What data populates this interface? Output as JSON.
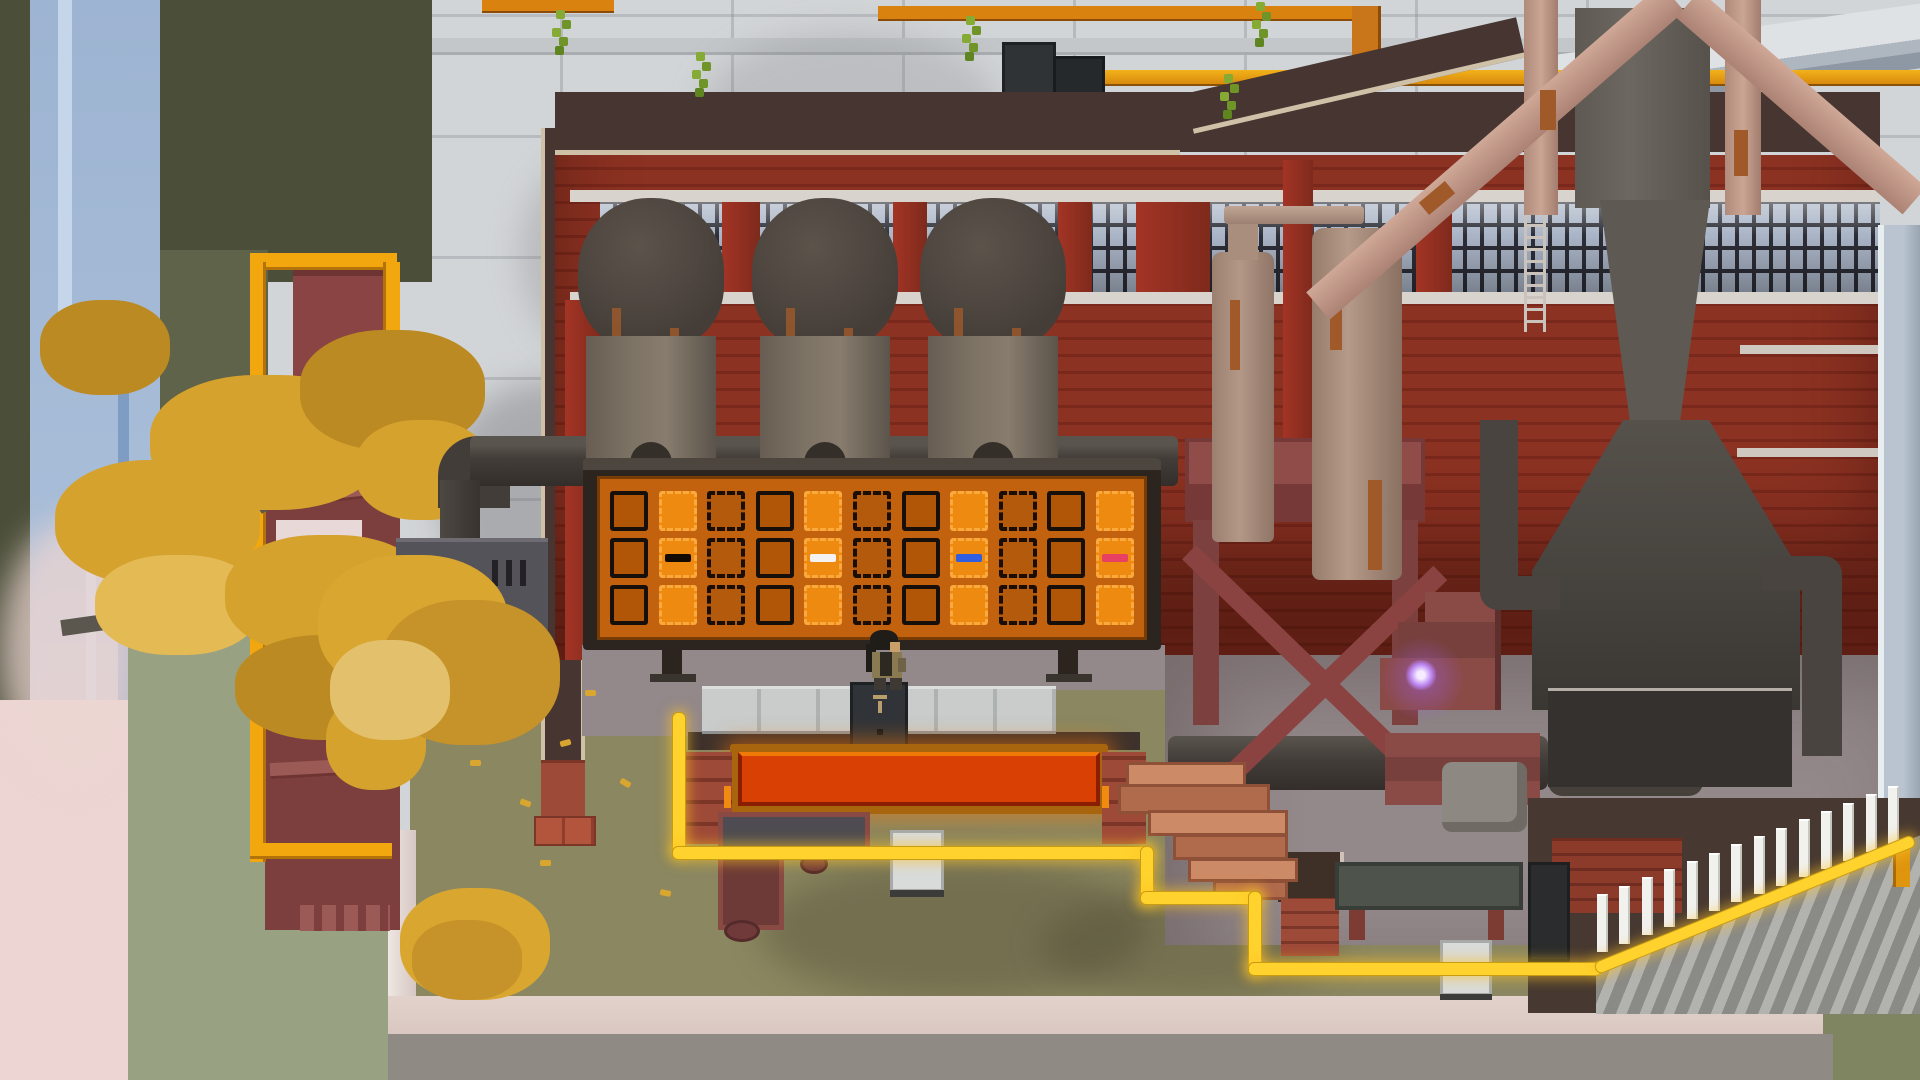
{
  "meta": {
    "type": "game-screenshot",
    "view": "top-down pixel-art factory yard"
  },
  "palette": {
    "concrete": "#d2d5d7",
    "cliff": "#5f6349",
    "cliffDark": "#4b4f3a",
    "sage": "#99a183",
    "waterfall": "#a3b9d6",
    "waterfallLight": "#c6d6ea",
    "waterfallDark": "#7f9cc2",
    "mist": "#ecd5d2",
    "treeLeaf": "#d6a22e",
    "treeLeafDark": "#bc8a22",
    "treeLeafLight": "#e4ba55",
    "branch": "#5b564e",
    "towerMaroon": "#7c3f3d",
    "plank": "#9c5a56",
    "railYellow": "#f2a70e",
    "brown": "#463530",
    "trim": "#cfc0a8",
    "brick": "#8c3222",
    "brickDark": "#6f241a",
    "brickBright": "#a33425",
    "mortar": "#7a281b",
    "sillWhite": "#d8d4cd",
    "paneBlue": "#a9b4c6",
    "paneDark": "#2c2d36",
    "rust": "#a05a2a",
    "rustPipe": "#cba593",
    "pipeDark": "#3e3936",
    "boardFrame": "#2b241f",
    "boardBg": "#c2620f",
    "slotFill": "#b05606",
    "slotLine": "#17100a",
    "tileFill": "#ee8a10",
    "tileLine": "#f9a93e",
    "ghostLine": "#190d04",
    "markBlack": "#140a04",
    "markWhite": "#f4f2f2",
    "markBlue": "#2f5fe0",
    "markPink": "#e84063",
    "floorMauve": "#93888a",
    "walkPanel": "#c9cccb",
    "bandBrown": "#3f322c",
    "consoleDark": "#303438",
    "troughFill": "#d84103",
    "troughDark": "#8a1e02",
    "capBrick": "#9e4a38",
    "cartTop": "#4e4c52",
    "cartEdge": "#8a4a44",
    "grass": "#8b8760",
    "leaf": "#d9a62f",
    "palletLight": "#cd8a66",
    "palletDark": "#b06a4c",
    "benchTop": "#4e544c",
    "benchLeg": "#7c3b33",
    "stepMaroon": "#8a4a45",
    "purpleCore": "#f6ecff",
    "cable": "#ffd22e",
    "cableGlow": "rgba(255,195,35,0.55)",
    "stairStep": "#9d9d98",
    "baluster": "#f1f1ee",
    "pinkWall": "#d9c6c0",
    "pathGrey": "#8f8a84",
    "hopperGrey": "#6d6761",
    "furnaceBase": "#34312e",
    "paleWall": "#b9c4d0",
    "vineGreen": "#86ab35",
    "squareDark": "#303335",
    "orangePipe": "#d9820f"
  },
  "board": {
    "rows": 3,
    "cols": 11,
    "col_types": [
      "slot",
      "tile",
      "ghost",
      "slot",
      "tile",
      "ghost",
      "slot",
      "tile",
      "ghost",
      "slot",
      "tile"
    ],
    "marks": [
      {
        "row": 1,
        "col": 1,
        "color_key": "markBlack"
      },
      {
        "row": 1,
        "col": 4,
        "color_key": "markWhite"
      },
      {
        "row": 1,
        "col": 7,
        "color_key": "markBlue"
      },
      {
        "row": 1,
        "col": 10,
        "color_key": "markPink"
      }
    ]
  },
  "tanks": {
    "x": [
      578,
      752,
      920
    ],
    "y": 198
  },
  "window_pillars": [
    [
      122,
      38
    ],
    [
      293,
      34
    ],
    [
      458,
      34
    ],
    [
      536,
      74
    ],
    [
      683,
      30
    ],
    [
      816,
      36
    ]
  ],
  "balusters": {
    "count": 14,
    "x0": 1597,
    "y0": 950,
    "dx": 22.4,
    "dy": -8.3
  },
  "vines": [
    [
      556,
      10
    ],
    [
      696,
      52
    ],
    [
      966,
      16
    ],
    [
      1256,
      2
    ],
    [
      1224,
      74
    ]
  ],
  "cable_segments": [
    [
      672,
      712,
      12,
      140
    ],
    [
      672,
      846,
      478,
      12
    ],
    [
      1140,
      846,
      12,
      57
    ],
    [
      1140,
      891,
      118,
      12
    ],
    [
      1248,
      891,
      12,
      82
    ],
    [
      1248,
      962,
      352,
      12
    ]
  ],
  "cable_diagonal": {
    "x": 1593,
    "y": 963,
    "len": 342,
    "angle": -22
  }
}
